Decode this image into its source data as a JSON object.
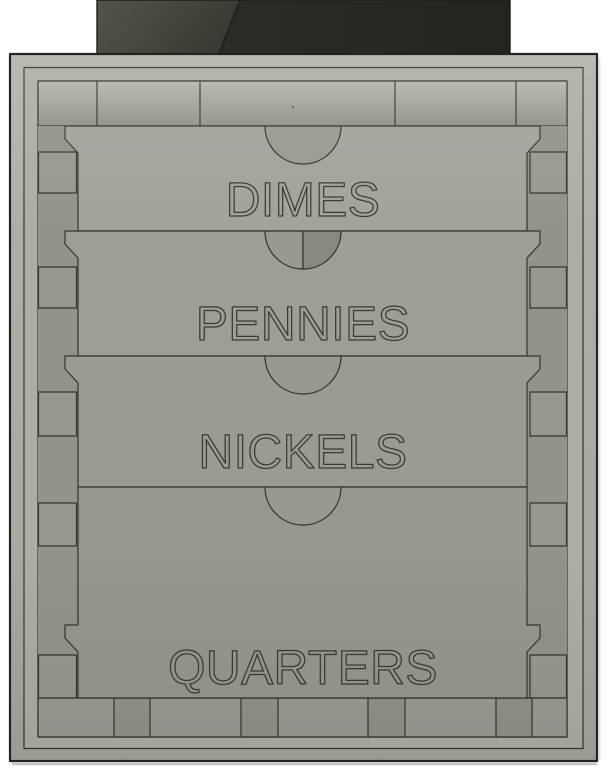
{
  "scene": {
    "description": "front orthographic view of a four-drawer coin sorter cabinet with hopper"
  },
  "drawers": [
    {
      "label": "DIMES",
      "fill": "#a3a29b"
    },
    {
      "label": "PENNIES",
      "fill": "#9e9d96"
    },
    {
      "label": "NICKELS",
      "fill": "#9b9a93"
    },
    {
      "label": "QUARTERS",
      "fill": "#98978f"
    }
  ],
  "palette": {
    "background": "#ffffff",
    "outline": "#35342f",
    "outline_dark": "#24231f",
    "outer_face_light": "#b3b2aa",
    "outer_face_dark": "#a5a49d",
    "rim_face": "#aeada5",
    "interior_face": "#96958d",
    "top_band_light": "#b6b5ad",
    "top_band_dark": "#908f88",
    "side_band": "#93928b",
    "slot_face": "#999890",
    "bottom_band": "#9b9a93",
    "bottom_slot": "#929189",
    "notch_light": "#9a9990",
    "notch_shadow": "#89887f",
    "hopper_left_light": "#55544c",
    "hopper_left_dark": "#3a3933",
    "hopper_right": "#2c2b27",
    "hopper_right_dark": "#242320",
    "engrave_stroke": "#3b3a33",
    "drop_shadow": "#c6c6c2"
  }
}
